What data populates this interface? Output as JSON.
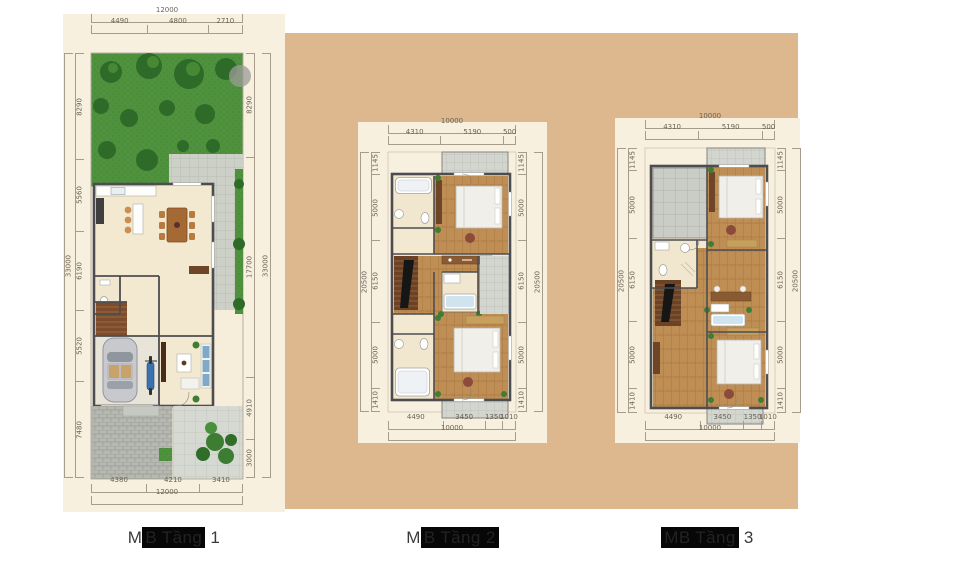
{
  "page": {
    "background": "#ffffff",
    "canvas_tan": "#ddb88f",
    "panel_cream": "#f8f0df",
    "dimension_line_color": "#a79c8c",
    "dimension_text_color": "#6b6256",
    "caption_highlight": "#070707"
  },
  "captions": [
    {
      "full": "MB Tầng 1",
      "pre": "M",
      "highlight": "B Tầng",
      "post": " 1"
    },
    {
      "full": "MB Tầng 2",
      "pre": "M",
      "highlight": "B Tầng 2",
      "post": ""
    },
    {
      "full": "MB Tầng 3",
      "pre": "",
      "highlight": "MB Tầng",
      "post": " 3"
    }
  ],
  "plan1": {
    "name": "ground-floor-plan",
    "dims": {
      "top_total": "12000",
      "top": [
        "4490",
        "4800",
        "2710"
      ],
      "bottom": [
        "4380",
        "4210",
        "3410"
      ],
      "bottom_total": "12000",
      "left": [
        "8290",
        "5560",
        "6190",
        "5520",
        "7480"
      ],
      "left_total": "33000",
      "right": [
        "8290",
        "17700",
        "4910",
        "3000"
      ],
      "right_total": "33000"
    },
    "features": [
      "garden-trees",
      "paved-patio",
      "kitchen-counter",
      "dining-table",
      "wc-toilet",
      "staircase",
      "garage-car",
      "motorbike",
      "living-room-sofa",
      "tv-cabinet",
      "paver-driveway",
      "shrubs"
    ]
  },
  "plan2": {
    "name": "second-floor-plan",
    "dims": {
      "top_total": "10000",
      "top": [
        "4310",
        "5190",
        "500"
      ],
      "bottom": [
        "4490",
        "3450",
        "1350",
        "1010"
      ],
      "bottom_total": "10000",
      "left": [
        "1145",
        "5000",
        "6150",
        "5000",
        "1410"
      ],
      "left_total": "20500",
      "right": [
        "1145",
        "5000",
        "6150",
        "5000",
        "1410"
      ],
      "right_total": "20500"
    },
    "features": [
      "front-balcony",
      "bathroom-tub",
      "bedroom-bed",
      "wardrobe",
      "staircase",
      "dresser-console",
      "middle-bathroom",
      "side-terrace",
      "bathroom-tub-2",
      "bedroom-bed-2",
      "rear-balcony"
    ]
  },
  "plan3": {
    "name": "third-floor-plan",
    "dims": {
      "top_total": "10000",
      "top": [
        "4310",
        "5190",
        "500"
      ],
      "bottom": [
        "4490",
        "3450",
        "1350",
        "1010"
      ],
      "bottom_total": "10000",
      "left": [
        "1145",
        "5000",
        "6150",
        "5000",
        "1410"
      ],
      "left_total": "20500",
      "right": [
        "1145",
        "5000",
        "6150",
        "5000",
        "1410"
      ],
      "right_total": "20500"
    },
    "features": [
      "roof-terrace",
      "front-balcony",
      "bedroom-bed",
      "bathroom",
      "staircase",
      "desk-console",
      "laundry-tub",
      "cabinet",
      "bedroom-bed-2",
      "rear-balcony"
    ]
  }
}
